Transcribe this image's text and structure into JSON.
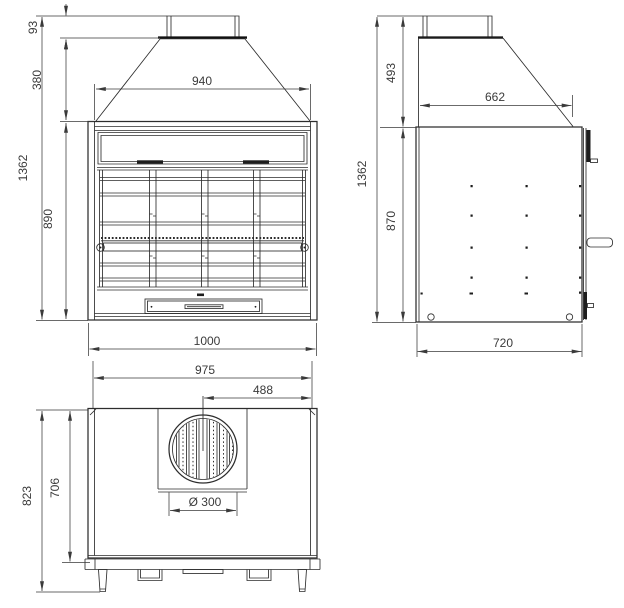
{
  "drawing": {
    "kind": "technical-drawing-3-views",
    "background": "#ffffff",
    "line_color": "#2d2d2d",
    "views": {
      "front": {
        "label": "front view",
        "dims": {
          "chimney_height": "93",
          "hood_height": "380",
          "overall_height": "1362",
          "firebox_height": "890",
          "hood_width": "940",
          "overall_width": "1000"
        }
      },
      "side": {
        "label": "side view",
        "dims": {
          "hood_height": "493",
          "overall_height": "1362",
          "body_height": "870",
          "hood_depth": "662",
          "body_depth": "720"
        }
      },
      "top": {
        "label": "top view",
        "dims": {
          "overall_width": "975",
          "flue_center_from_right": "488",
          "overall_depth": "823",
          "body_depth": "706",
          "flue_diameter": "Ø 300"
        }
      }
    }
  }
}
